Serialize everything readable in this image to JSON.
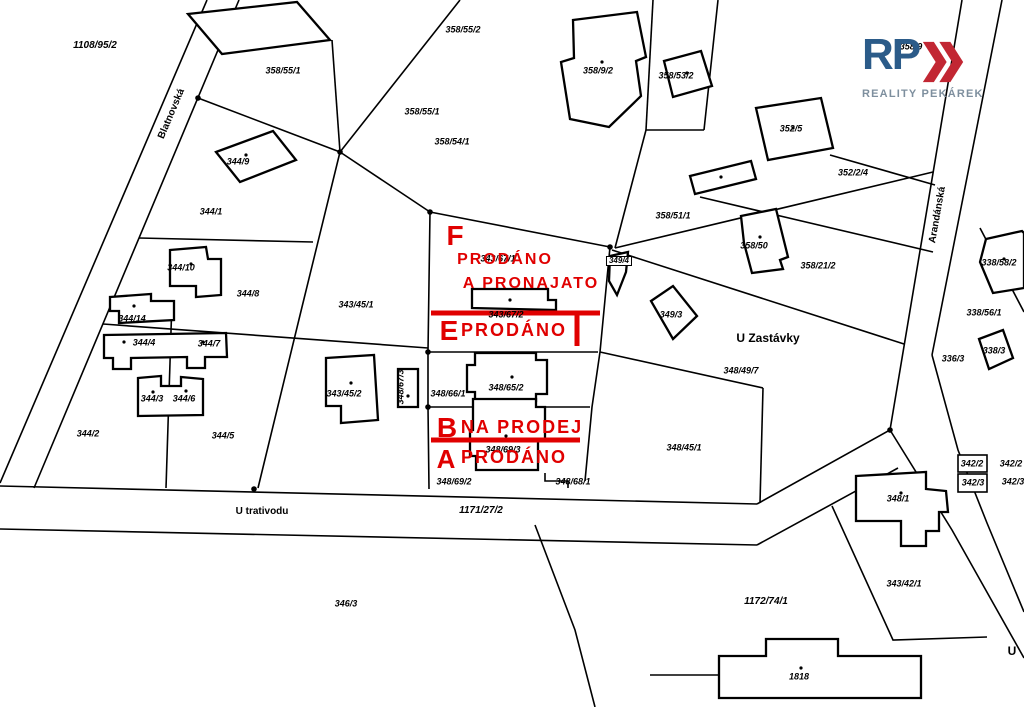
{
  "colors": {
    "red": "#e00000",
    "logo_blue": "#2b5b89",
    "logo_red": "#c22733",
    "logo_gray": "#7e8f9e",
    "line": "#000000",
    "background": "#ffffff"
  },
  "logo": {
    "rp": "RP",
    "name": "REALITY PEKÁREK"
  },
  "map": {
    "street_labels": [
      {
        "text": "Blatnovská",
        "x": 172,
        "y": 114,
        "rotate": -67
      },
      {
        "text": "Arandánská",
        "x": 938,
        "y": 215,
        "rotate": -80
      },
      {
        "text": "U trativodu",
        "x": 262,
        "y": 512
      },
      {
        "text": "U Zastávky",
        "x": 768,
        "y": 338,
        "size": 12
      },
      {
        "text": "U",
        "x": 1012,
        "y": 651,
        "size": 12
      }
    ],
    "parcel_labels": [
      {
        "text": "1108/95/2",
        "x": 95,
        "y": 46,
        "size": 10
      },
      {
        "text": "358/55/1",
        "x": 283,
        "y": 71
      },
      {
        "text": "358/55/2",
        "x": 463,
        "y": 30
      },
      {
        "text": "358/55/1",
        "x": 422,
        "y": 112
      },
      {
        "text": "358/54/1",
        "x": 452,
        "y": 142
      },
      {
        "text": "358/9/2",
        "x": 598,
        "y": 71
      },
      {
        "text": "358/53/2",
        "x": 676,
        "y": 76
      },
      {
        "text": "352/5",
        "x": 791,
        "y": 129
      },
      {
        "text": "352/2/4",
        "x": 853,
        "y": 173
      },
      {
        "text": "358/51/1",
        "x": 673,
        "y": 216
      },
      {
        "text": "358/50",
        "x": 754,
        "y": 246
      },
      {
        "text": "358/21/2",
        "x": 818,
        "y": 266
      },
      {
        "text": "358/9",
        "x": 911,
        "y": 47
      },
      {
        "text": "338/58/2",
        "x": 999,
        "y": 263
      },
      {
        "text": "338/56/1",
        "x": 984,
        "y": 313
      },
      {
        "text": "336/3",
        "x": 953,
        "y": 359
      },
      {
        "text": "338/3",
        "x": 994,
        "y": 351
      },
      {
        "text": "344/9",
        "x": 238,
        "y": 162
      },
      {
        "text": "344/1",
        "x": 211,
        "y": 212
      },
      {
        "text": "344/10",
        "x": 181,
        "y": 268
      },
      {
        "text": "344/8",
        "x": 248,
        "y": 294
      },
      {
        "text": "343/45/1",
        "x": 356,
        "y": 305
      },
      {
        "text": "344/14",
        "x": 132,
        "y": 319
      },
      {
        "text": "344/4",
        "x": 144,
        "y": 343
      },
      {
        "text": "344/7",
        "x": 209,
        "y": 344
      },
      {
        "text": "344/3",
        "x": 152,
        "y": 399
      },
      {
        "text": "344/6",
        "x": 184,
        "y": 399
      },
      {
        "text": "344/2",
        "x": 88,
        "y": 434
      },
      {
        "text": "344/5",
        "x": 223,
        "y": 436
      },
      {
        "text": "343/45/2",
        "x": 344,
        "y": 394
      },
      {
        "text": "348/67/3",
        "x": 401,
        "y": 387,
        "rotate": -90
      },
      {
        "text": "348/66/1",
        "x": 448,
        "y": 394
      },
      {
        "text": "348/65/2",
        "x": 506,
        "y": 388
      },
      {
        "text": "343/67/2",
        "x": 506,
        "y": 315
      },
      {
        "text": "343/67/1",
        "x": 498,
        "y": 259
      },
      {
        "text": "349/4",
        "x": 619,
        "y": 261,
        "box": true
      },
      {
        "text": "349/3",
        "x": 671,
        "y": 315
      },
      {
        "text": "348/49/7",
        "x": 741,
        "y": 371
      },
      {
        "text": "348/45/1",
        "x": 684,
        "y": 448
      },
      {
        "text": "348/69/3",
        "x": 503,
        "y": 450
      },
      {
        "text": "348/69/2",
        "x": 454,
        "y": 482
      },
      {
        "text": "348/68/1",
        "x": 573,
        "y": 482
      },
      {
        "text": "346/3",
        "x": 346,
        "y": 604
      },
      {
        "text": "1171/27/2",
        "x": 481,
        "y": 511,
        "size": 10
      },
      {
        "text": "1172/74/1",
        "x": 766,
        "y": 602,
        "size": 10
      },
      {
        "text": "343/42/1",
        "x": 904,
        "y": 584
      },
      {
        "text": "348/1",
        "x": 898,
        "y": 499
      },
      {
        "text": "342/2",
        "x": 972,
        "y": 464
      },
      {
        "text": "342/3",
        "x": 973,
        "y": 483
      },
      {
        "text": "342/2",
        "x": 1011,
        "y": 464
      },
      {
        "text": "342/3",
        "x": 1013,
        "y": 482
      },
      {
        "text": "1818",
        "x": 799,
        "y": 677
      }
    ],
    "annotations": [
      {
        "text": "F",
        "x": 455,
        "y": 236,
        "cls": "zletter"
      },
      {
        "text": "PRODÁNO",
        "x": 505,
        "y": 260,
        "cls": "ztextF"
      },
      {
        "text": "A PRONAJATO",
        "x": 531,
        "y": 284,
        "cls": "ztextF"
      },
      {
        "text": "E",
        "x": 449,
        "y": 331,
        "cls": "zletter"
      },
      {
        "text": "PRODÁNO",
        "x": 514,
        "y": 330,
        "cls": "ztext"
      },
      {
        "text": "B",
        "x": 447,
        "y": 428,
        "cls": "zletter"
      },
      {
        "text": "NA PRODEJ",
        "x": 522,
        "y": 427,
        "cls": "ztext"
      },
      {
        "text": "A",
        "x": 446,
        "y": 459,
        "cls": "zletterA"
      },
      {
        "text": "PRODÁNO",
        "x": 514,
        "y": 457,
        "cls": "ztext"
      }
    ]
  }
}
